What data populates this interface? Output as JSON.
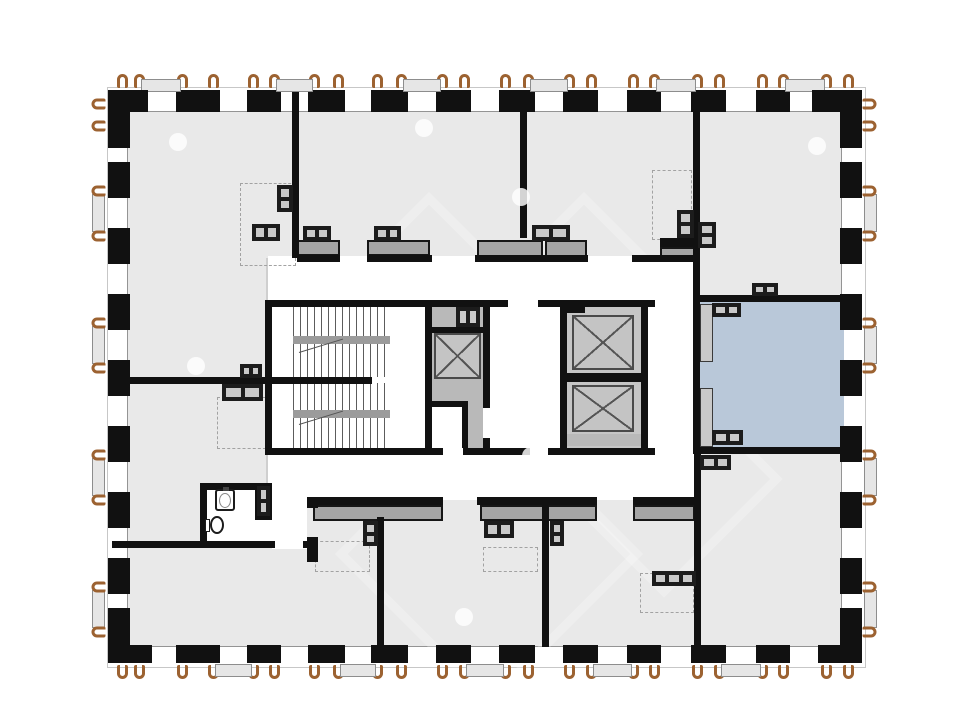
{
  "plan": {
    "description": "Residential tower floor plan with central stair and elevator core, perimeter window wall and one highlighted unit room",
    "highlighted_room": {
      "position": "right-center",
      "fill": "#b9c8d9"
    },
    "colors": {
      "background": "#ffffff",
      "floor": "#e9e9e9",
      "wall": "#111111",
      "corridor": "#ffffff",
      "kitchen_counter": "#a5a5a5",
      "core_gray": "#c0c0c0",
      "anchor_brown": "#9c6231",
      "window_sill": "#e6e6e6",
      "dashed_outline": "#a2a2a2"
    },
    "elements": {
      "elevator_count": 3,
      "stair_flights": 2,
      "bathroom_fixtures": [
        "toilet",
        "sink"
      ],
      "kitchen_counter_count": 7,
      "closet_outline_count": 7,
      "balcony_anchor_sides": [
        "top",
        "right",
        "bottom",
        "left"
      ],
      "highlight_dot_count": 7
    }
  }
}
